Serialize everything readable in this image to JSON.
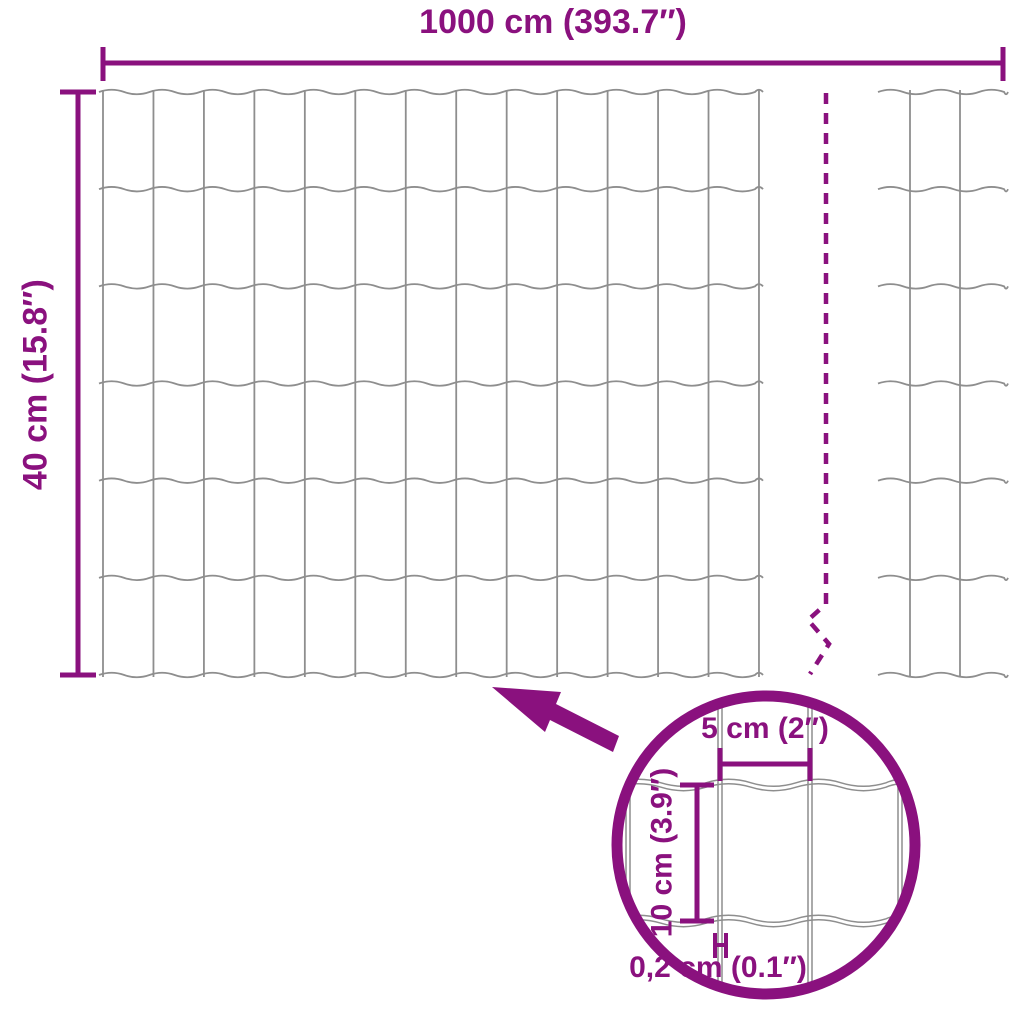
{
  "diagram": {
    "type": "product-dimension-diagram",
    "subject": "garden wire mesh fence roll",
    "labels": {
      "total_width": "1000 cm (393.7″)",
      "total_height": "40 cm (15.8″)",
      "detail": {
        "mesh_width": "5 cm (2″)",
        "mesh_height": "10 cm (3.9″)",
        "wire_thickness": "0,2 cm (0.1″)"
      }
    },
    "icons": {
      "zoom_arrow": "thick-arrow-pointing-up-left-from-magnifier-to-mesh",
      "magnifier": "detail-zoom-circle",
      "break_line": "dashed-continuation-break-line"
    },
    "colors": {
      "accent": "#8A117E",
      "wire": "#8E8E8E",
      "background": "#FFFFFF"
    }
  }
}
